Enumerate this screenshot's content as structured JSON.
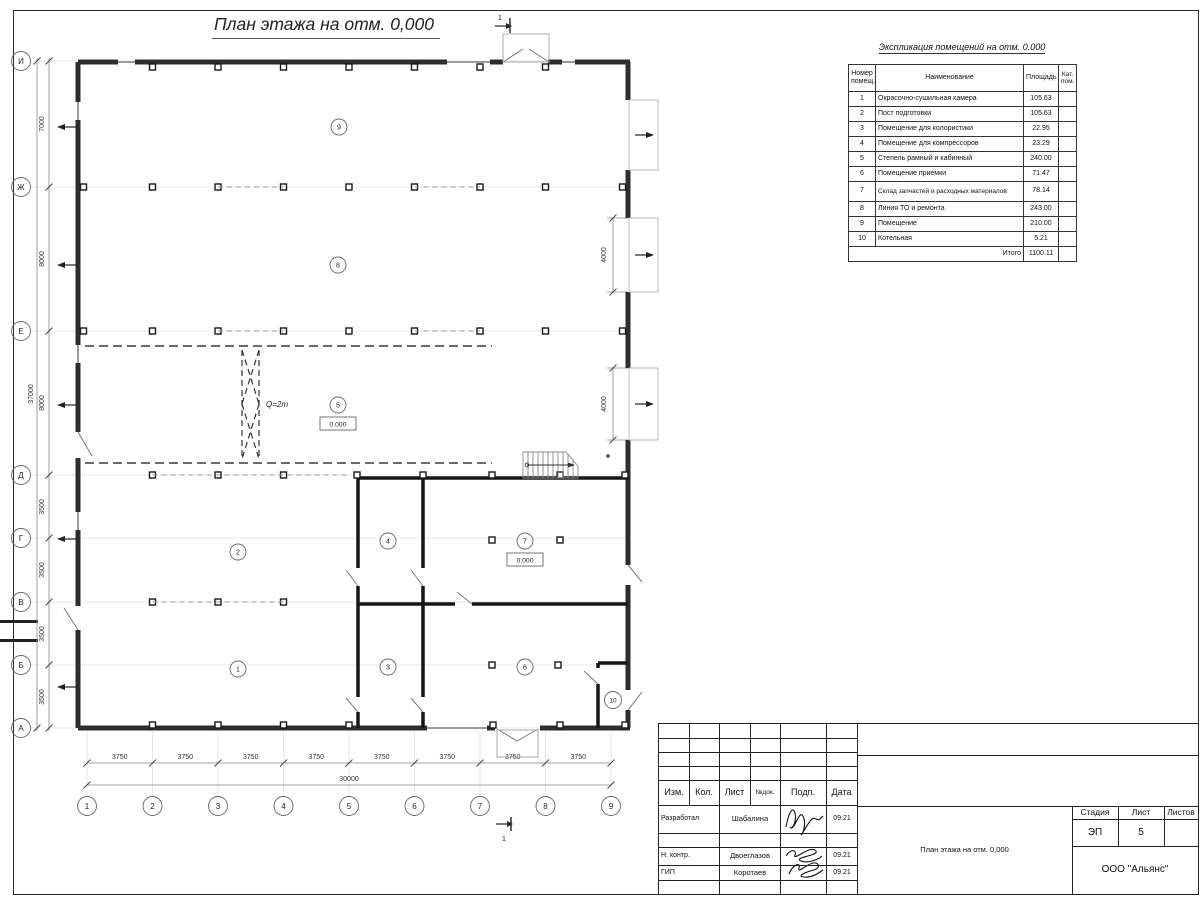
{
  "sheet": {
    "title": "План этажа на отм. 0,000"
  },
  "schedule": {
    "title": "Экспликация помещений на отм. 0.000",
    "headers": {
      "num": "Номер помещ.",
      "name": "Наименование",
      "area": "Площадь",
      "cat": "Кат. пом."
    },
    "rows": [
      {
        "num": "1",
        "name": "Окрасочно-сушильная камера",
        "area": "105.63"
      },
      {
        "num": "2",
        "name": "Пост подготовки",
        "area": "105.63"
      },
      {
        "num": "3",
        "name": "Помещение для колористики",
        "area": "22.95"
      },
      {
        "num": "4",
        "name": "Помещение для компрессоров",
        "area": "23.29"
      },
      {
        "num": "5",
        "name": "Степель рамный и кабинный",
        "area": "240.00"
      },
      {
        "num": "6",
        "name": "Помещение приемки",
        "area": "71.47"
      },
      {
        "num": "7",
        "name": "Склад запчастей и расходных материалов",
        "area": "78.14"
      },
      {
        "num": "8",
        "name": "Линия ТО и ремонта",
        "area": "243.00"
      },
      {
        "num": "9",
        "name": "Помещение",
        "area": "210.00"
      },
      {
        "num": "10",
        "name": "Котельная",
        "area": "5.21"
      }
    ],
    "total_label": "Итого",
    "total_value": "1100.11"
  },
  "plan": {
    "row_axes": [
      "И",
      "Ж",
      "Е",
      "Д",
      "Г",
      "В",
      "Б",
      "А"
    ],
    "col_axes": [
      "1",
      "2",
      "3",
      "4",
      "5",
      "6",
      "7",
      "8",
      "9"
    ],
    "v_dims": [
      "7000",
      "8000",
      "8000",
      "3500",
      "3500",
      "3500",
      "3500"
    ],
    "v_total": "37000",
    "h_dims": [
      "3750",
      "3750",
      "3750",
      "3750",
      "3750",
      "3750",
      "3750",
      "3750"
    ],
    "h_total": "30000",
    "gate_dim": "4000",
    "crane_label": "Q=2т",
    "elevation": "0.000",
    "section_mark": "1",
    "rooms": [
      "1",
      "2",
      "3",
      "4",
      "5",
      "6",
      "7",
      "8",
      "9",
      "10"
    ]
  },
  "titleblock": {
    "cols": [
      "Изм.",
      "Кол.",
      "Лист",
      "№док.",
      "Подп.",
      "Дата"
    ],
    "signers": [
      {
        "role": "Разработал",
        "name": "Шабалина",
        "date": "09.21"
      },
      {
        "role": "Н. контр.",
        "name": "Двоеглазов",
        "date": "09.21"
      },
      {
        "role": "ГИП",
        "name": "Коротаев",
        "date": "09.21"
      }
    ],
    "stage_label": "Стадия",
    "sheet_label": "Лист",
    "sheets_label": "Листов",
    "stage": "ЭП",
    "sheet_no": "5",
    "doc_title": "План этажа на отм. 0,000",
    "company": "ООО \"Альянс\""
  }
}
